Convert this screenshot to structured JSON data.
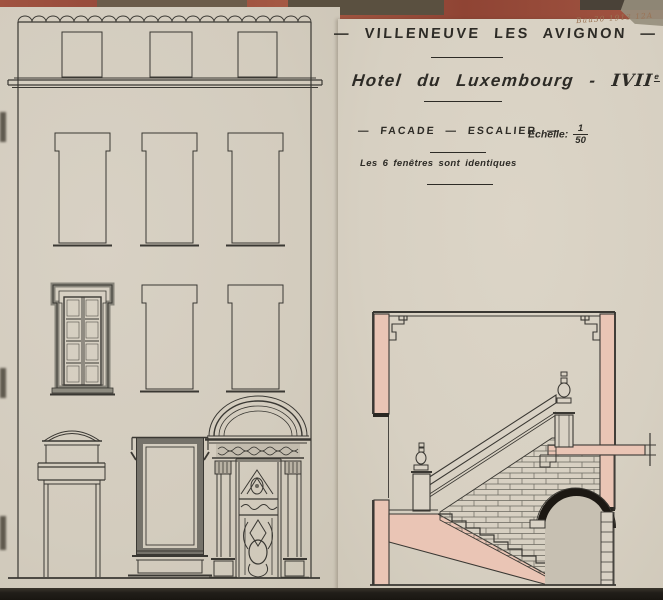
{
  "header": {
    "pencil_note": "Bau30 1913 12A",
    "title_dash_left": "—",
    "title": "VILLENEUVE LES AVIGNON",
    "title_dash_right": "—",
    "subtitle": "Hotel du Luxembourg",
    "subtitle_sep": "-",
    "century": "IVII",
    "century_sup": "e",
    "label_dash1": "—",
    "label_facade": "FACADE",
    "label_dash2": "—",
    "label_escalier": "ESCALIER",
    "label_dash3": "—",
    "scale_label": "Echelle:",
    "scale_numerator": "1",
    "scale_denominator": "50",
    "note": "Les 6 fenêtres sont identiques"
  },
  "drawings": {
    "facade": "facade-elevation-six-identical-windows",
    "section": "staircase-cross-section"
  },
  "colors": {
    "photo_background_red": "#9e4f3b",
    "paper": "#d6cfc2",
    "ink": "#3a3833",
    "wall_poche_pink": "#eac5b5",
    "arch_black": "#1c1813",
    "masonry_joint": "#6a675e",
    "bottom_band": "#211e19",
    "pencil": "#9a7456"
  }
}
